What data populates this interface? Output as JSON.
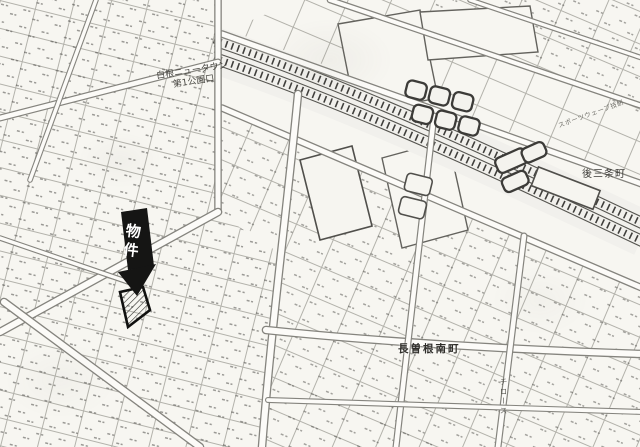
{
  "map": {
    "flag": {
      "label": "物件"
    },
    "labels": {
      "newtown_line1": "白根ニュータウン",
      "newtown_line2": "第1公園口",
      "gosanjo": "後三条町",
      "nagasone": "長曽根南町",
      "sports": "スポーツウェーブ技研",
      "road_vertical": "チロース"
    },
    "colors": {
      "paper": "#f7f6f1",
      "parcel_line": "#b3b2ab",
      "road_casing": "#85847e",
      "rail_dark": "#403f3c",
      "flag_bg": "#151514",
      "flag_text": "#ffffff"
    }
  }
}
